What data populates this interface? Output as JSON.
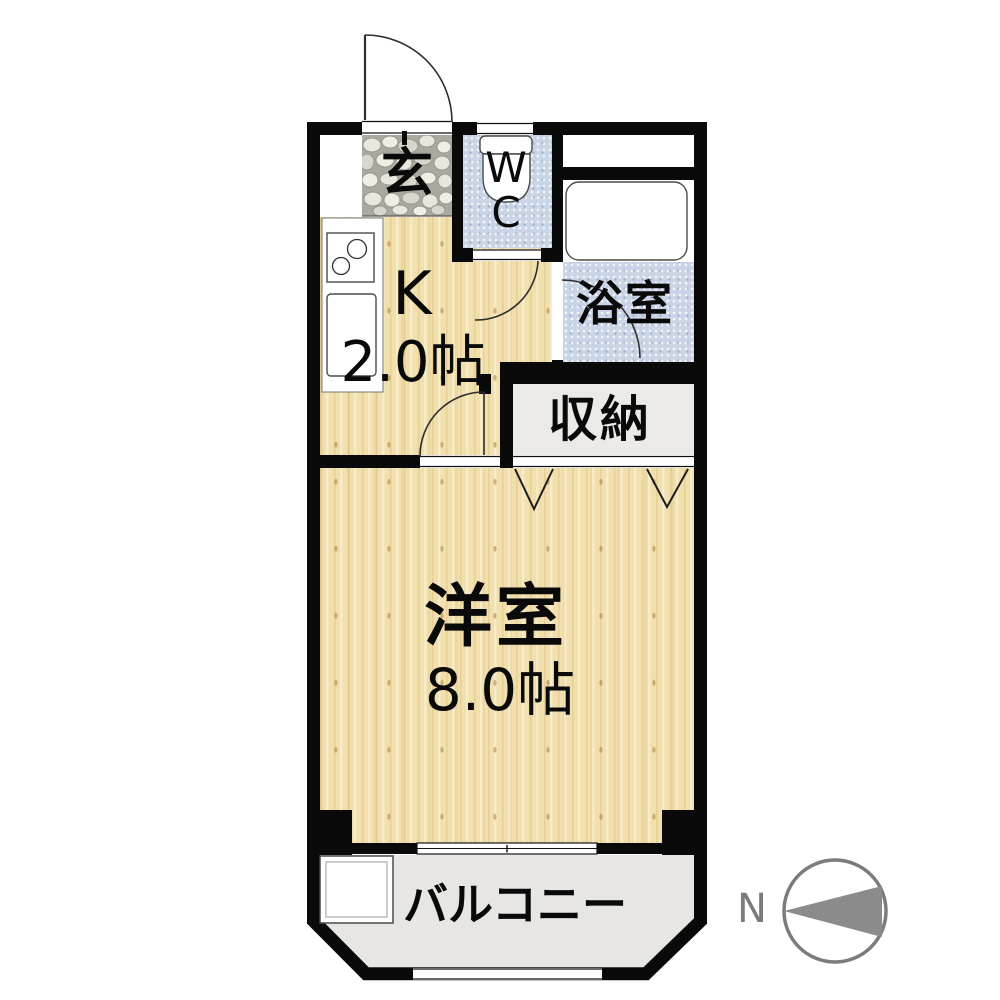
{
  "plan": {
    "rooms": {
      "genkan": {
        "label": "玄"
      },
      "wc": {
        "label": "WC"
      },
      "kitchen": {
        "label": "K",
        "size": "2.0帖"
      },
      "bathroom": {
        "label": "浴室"
      },
      "storage": {
        "label": "収納"
      },
      "main_room": {
        "label": "洋室",
        "size": "8.0帖"
      },
      "balcony": {
        "label": "バルコニー"
      }
    },
    "compass": {
      "north_label": "N"
    },
    "colors": {
      "wall": "#0a0a0a",
      "wood-floor": "#f1e0ae",
      "wet-floor": "#c9d4e6",
      "storage-floor": "#ebeae6",
      "balcony-floor": "#e7e6e3",
      "stone-base": "#aba89f",
      "compass-gray": "#7b7b7b"
    }
  }
}
